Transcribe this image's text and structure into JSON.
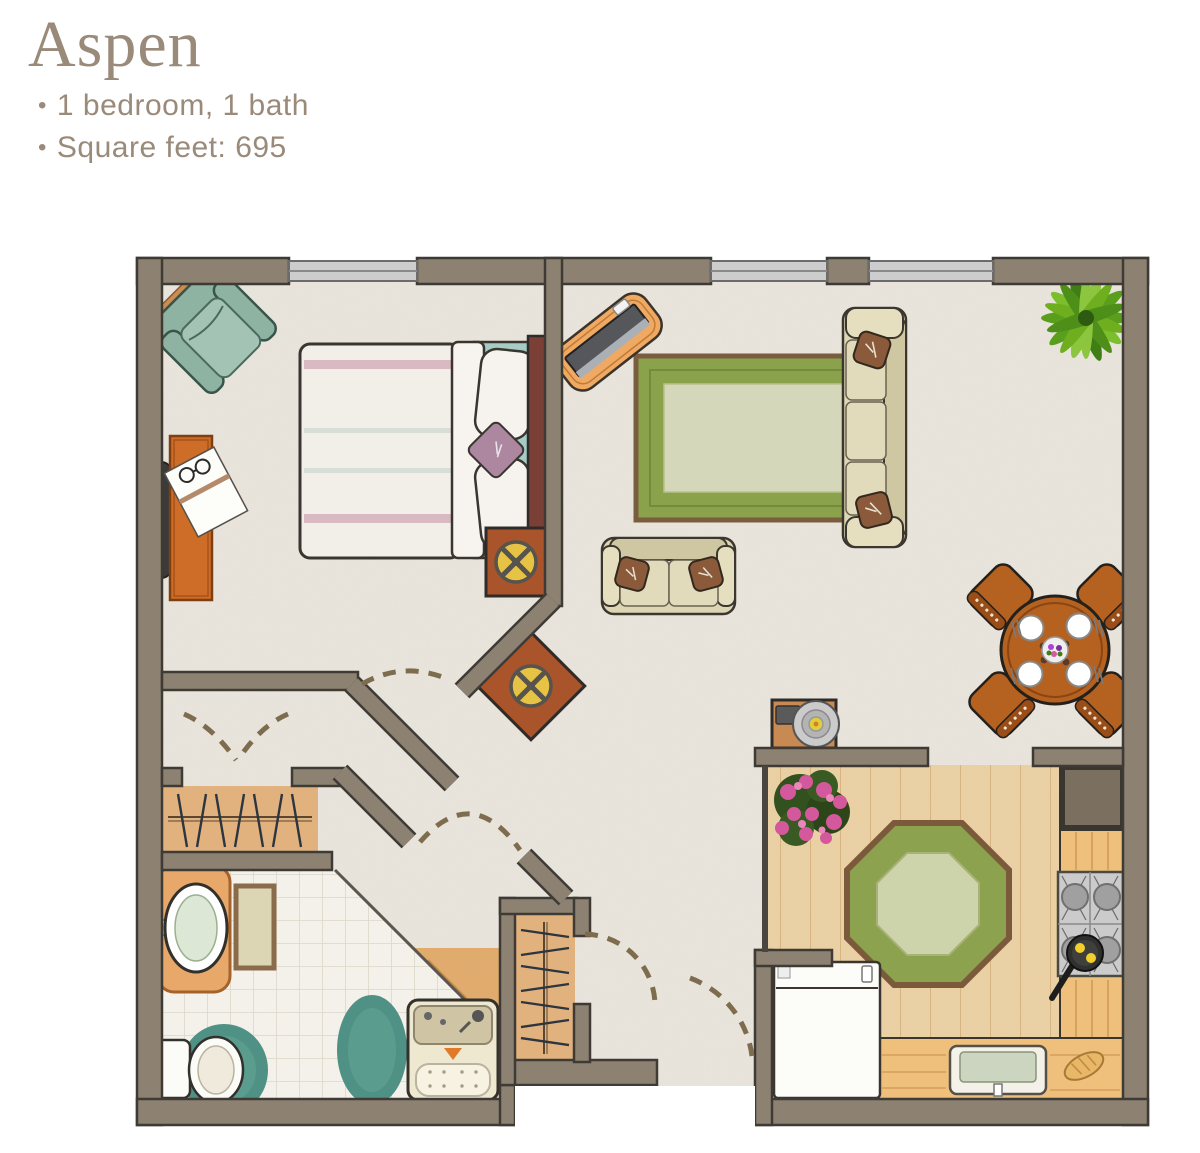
{
  "title": "Aspen",
  "bullet_char": "•",
  "features": [
    "1 bedroom, 1 bath",
    "Square feet: 695"
  ],
  "colors": {
    "title_text": "#9a8a7a",
    "wall_fill": "#8d8172",
    "wall_outline": "#3e3a35",
    "carpet": "#eae6de",
    "kitchen_floor": "#ecd2a4",
    "tile_floor": "#f7f4ee",
    "closet_wood": "#e2b27e",
    "rug_olive": "#8ba24c",
    "rug_center": "#d4d7ba",
    "octagon_border": "#8ca24e",
    "octagon_center": "#cdd3ab",
    "sofa_beige": "#ddd6b5",
    "pillow_brown": "#8a5a3a",
    "wood_furniture": "#cd6d28",
    "end_table_rust": "#a9542a",
    "pinwheel_yellow": "#e6c245",
    "armchair_teal": "#8fb3a2",
    "bath_rug_teal": "#4f9184",
    "bed_duvet": "#f2efe9",
    "bed_stripe_pink": "#d9bac2",
    "bed_sheet_teal": "#a6ccc6",
    "headboard": "#7a4036",
    "window_gray": "#cdcdcd",
    "door_arc": "#7d6c4e",
    "counter_wood": "#eec07c",
    "stove_gray": "#cbcbcb"
  }
}
